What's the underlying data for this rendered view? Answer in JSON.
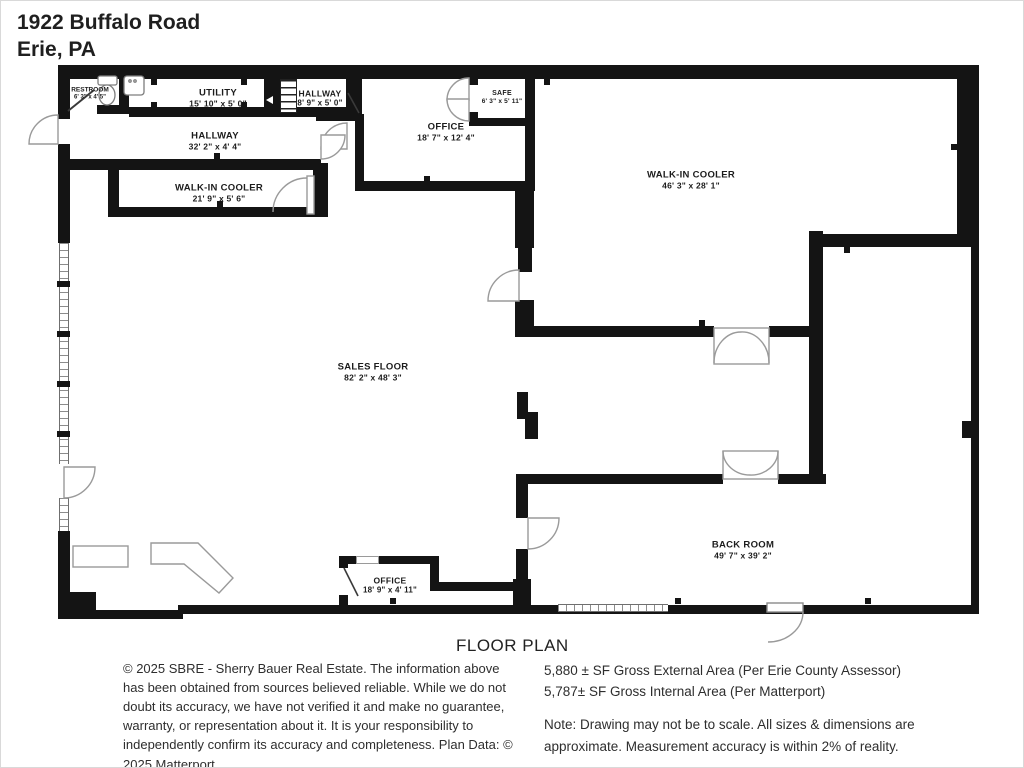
{
  "header": {
    "address_line1": "1922 Buffalo Road",
    "address_line2": "Erie, PA"
  },
  "rooms": [
    {
      "name": "RESTROOM",
      "dims": "6' 3\" x 4' 5\""
    },
    {
      "name": "UTILITY",
      "dims": "15' 10\" x 5' 0\""
    },
    {
      "name": "HALLWAY",
      "dims": "8' 9\" x 5' 0\""
    },
    {
      "name": "SAFE",
      "dims": "6' 3\" x 5' 11\""
    },
    {
      "name": "OFFICE",
      "dims": "18' 7\" x 12' 4\""
    },
    {
      "name": "HALLWAY",
      "dims": "32' 2\" x 4' 4\""
    },
    {
      "name": "WALK-IN COOLER",
      "dims": "21' 9\" x 5' 6\""
    },
    {
      "name": "WALK-IN COOLER",
      "dims": "46' 3\" x 28' 1\""
    },
    {
      "name": "SALES FLOOR",
      "dims": "82' 2\" x 48' 3\""
    },
    {
      "name": "OFFICE",
      "dims": "18' 9\" x 4' 11\""
    },
    {
      "name": "BACK ROOM",
      "dims": "49' 7\" x 39' 2\""
    }
  ],
  "footer": {
    "title": "FLOOR PLAN",
    "disclaimer": "© 2025 SBRE - Sherry Bauer Real Estate. The information above has been obtained from sources believed reliable. While we do not doubt its accuracy, we have not verified it and make no guarantee, warranty, or representation about it. It is your responsibility to independently confirm its accuracy and completeness. Plan Data: © 2025 Matterport.",
    "external_area": "5,880 ± SF Gross External Area (Per Erie County Assessor)",
    "internal_area": "5,787± SF Gross Internal Area (Per Matterport)",
    "note": "Note: Drawing may not be to scale. All sizes & dimensions are approximate. Measurement accuracy is within 2% of reality."
  },
  "colors": {
    "wall": "#141414",
    "text": "#1c1c1c",
    "fixture_outline": "#999999",
    "background": "#ffffff"
  }
}
